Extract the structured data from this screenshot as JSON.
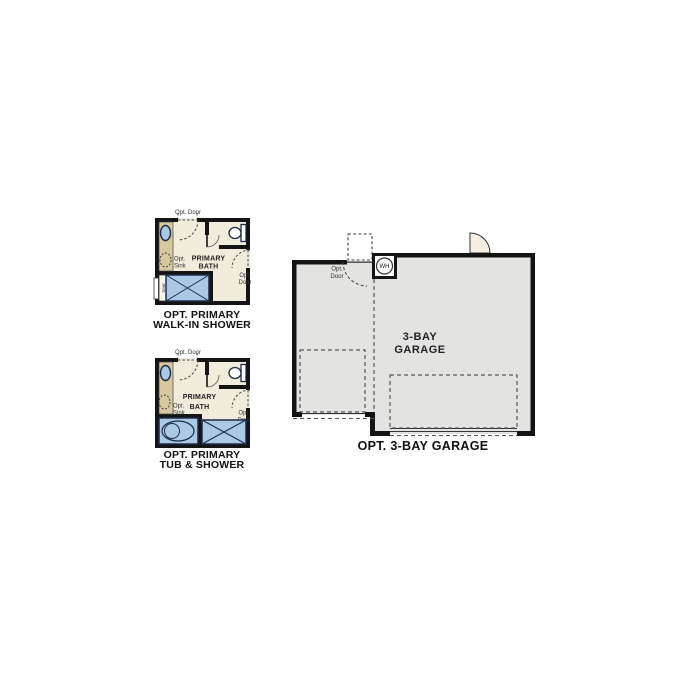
{
  "colors": {
    "wall": "#141414",
    "bath_floor": "#f2ecdc",
    "vanity": "#d8c8a0",
    "fixture_blue": "#abc8e4",
    "fixture_outline": "#1c2b4a",
    "garage_floor": "#e3e3e1",
    "door_fill": "#f6eee1",
    "dash_gray": "#444444"
  },
  "bath_walk_in": {
    "opt_door_top": "Opt. Door",
    "opt_sink": [
      "Opt.",
      "Sink"
    ],
    "room": [
      "PRIMARY",
      "BATH"
    ],
    "opt_door_right": [
      "Opt.",
      "Door"
    ],
    "seat": "Seat",
    "caption": [
      "OPT. PRIMARY",
      "WALK-IN SHOWER"
    ]
  },
  "bath_tub": {
    "opt_door_top": "Opt. Door",
    "opt_sink": [
      "Opt.",
      "Sink"
    ],
    "room": [
      "PRIMARY",
      "BATH"
    ],
    "opt_door_right": [
      "Opt.",
      "Door"
    ],
    "caption": [
      "OPT. PRIMARY",
      "TUB & SHOWER"
    ]
  },
  "garage": {
    "water_heater": "WH",
    "opt_door": [
      "Opt.",
      "Door"
    ],
    "room": [
      "3-BAY",
      "GARAGE"
    ],
    "caption": "OPT. 3-BAY GARAGE"
  }
}
